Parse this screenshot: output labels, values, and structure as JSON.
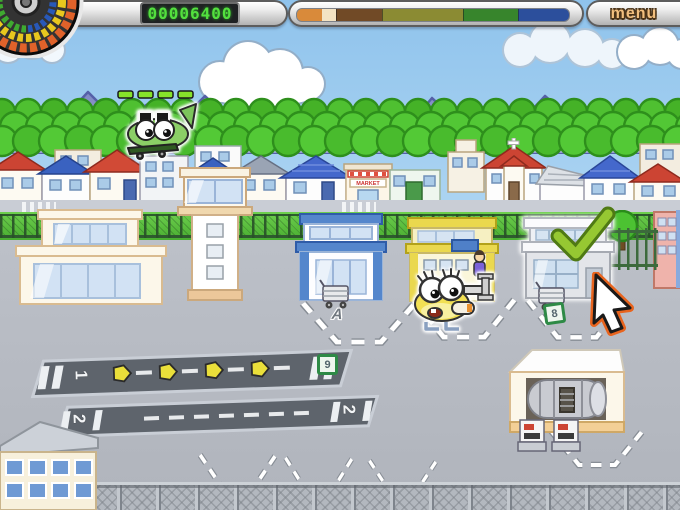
{
  "hud": {
    "score": "00006400",
    "menu_label": "menu",
    "progress_segments": [
      {
        "color": "#d98a3a",
        "width": 25,
        "tick": false
      },
      {
        "color": "#f3e3c3",
        "width": 14,
        "tick": false
      },
      {
        "color": "#714a26",
        "width": 46,
        "tick": true
      },
      {
        "color": "#8b8b33",
        "width": 80,
        "tick": true
      },
      {
        "color": "#37852c",
        "width": 55,
        "tick": true
      },
      {
        "color": "#2c4f9c",
        "width": 50,
        "tick": true
      }
    ]
  },
  "labels": {
    "runway1": "1",
    "runway2": "2",
    "gate_a": "A",
    "cart_sign": "8",
    "runway_sign": "9",
    "market_sign": "MARKET"
  },
  "colors": {
    "score_digits": "#53e03e",
    "menu_text": "#f2bf7e",
    "checkmark_green": "#96c832",
    "cursor_outline": "#e8641e",
    "sky_top": "#8fc3ec",
    "tarmac": "#b6bac2"
  }
}
